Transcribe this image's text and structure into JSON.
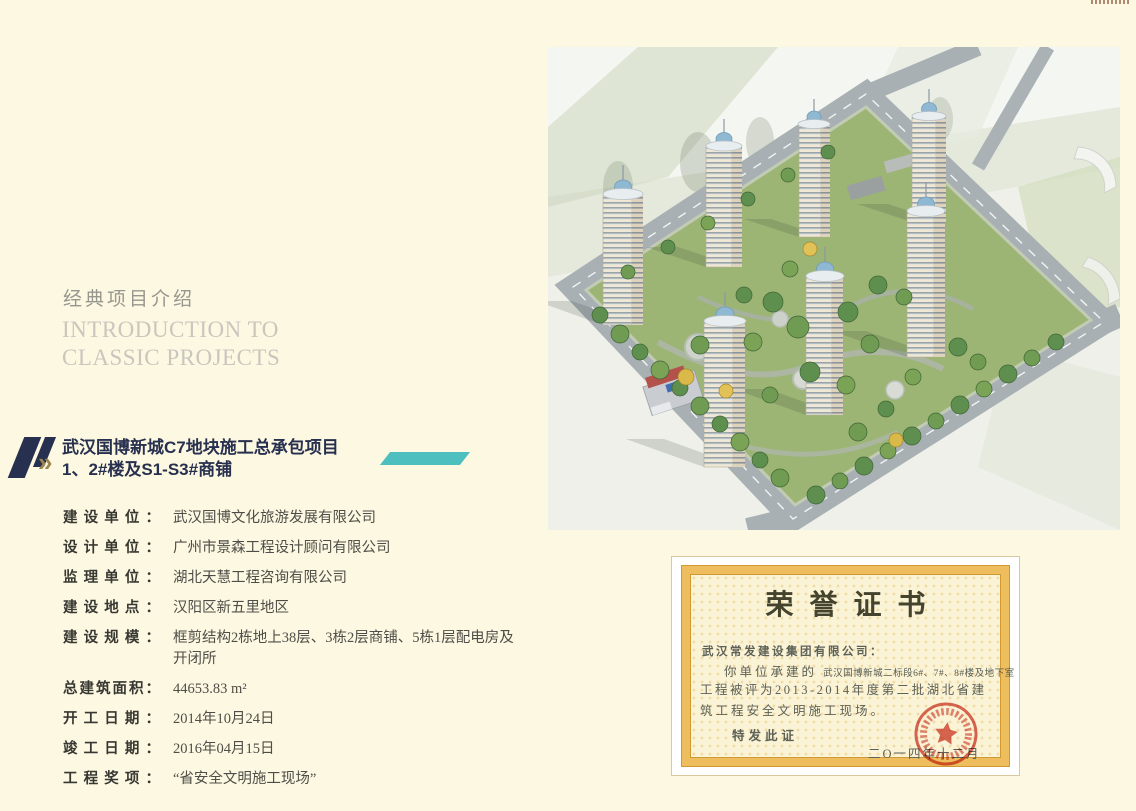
{
  "section_header": {
    "title_zh": "经典项目介绍",
    "title_en_line1": "INTRODUCTION TO",
    "title_en_line2": "CLASSIC PROJECTS"
  },
  "project": {
    "icon_chevrons": "»",
    "title_line1": "武汉国博新城C7地块施工总承包项目",
    "title_line2": "1、2#楼及S1-S3#商铺",
    "details": [
      {
        "label": "建设单位：",
        "value": "武汉国博文化旅游发展有限公司"
      },
      {
        "label": "设计单位：",
        "value": "广州市景森工程设计顾问有限公司"
      },
      {
        "label": "监理单位：",
        "value": "湖北天慧工程咨询有限公司"
      },
      {
        "label": "建设地点：",
        "value": "汉阳区新五里地区"
      },
      {
        "label": "建设规模：",
        "value": "框剪结构2栋地上38层、3栋2层商铺、5栋1层配电房及开闭所"
      },
      {
        "label": "总建筑面积：",
        "value": "44653.83 m²"
      },
      {
        "label": "开工日期：",
        "value": "2014年10月24日"
      },
      {
        "label": "竣工日期：",
        "value": "2016年04月15日"
      },
      {
        "label": "工程奖项：",
        "value": "“省安全文明施工现场”"
      }
    ]
  },
  "certificate": {
    "title": "荣誉证书",
    "recipient": "武汉常发建设集团有限公司：",
    "line_intro": "你单位承建的",
    "line_project_small": "武汉国博新城二标段6#、7#、8#楼及地下室",
    "line_award_1": "工程被评为2013-2014年度第二批湖北省建",
    "line_award_2": "筑工程安全文明施工现场。",
    "line_issue": "特发此证",
    "line_date": "二O一四年十二月"
  },
  "colors": {
    "accent_teal": "#4dbfbe",
    "navy": "#27304e",
    "gold": "#9c8650",
    "seal_red": "#d24a3c"
  }
}
